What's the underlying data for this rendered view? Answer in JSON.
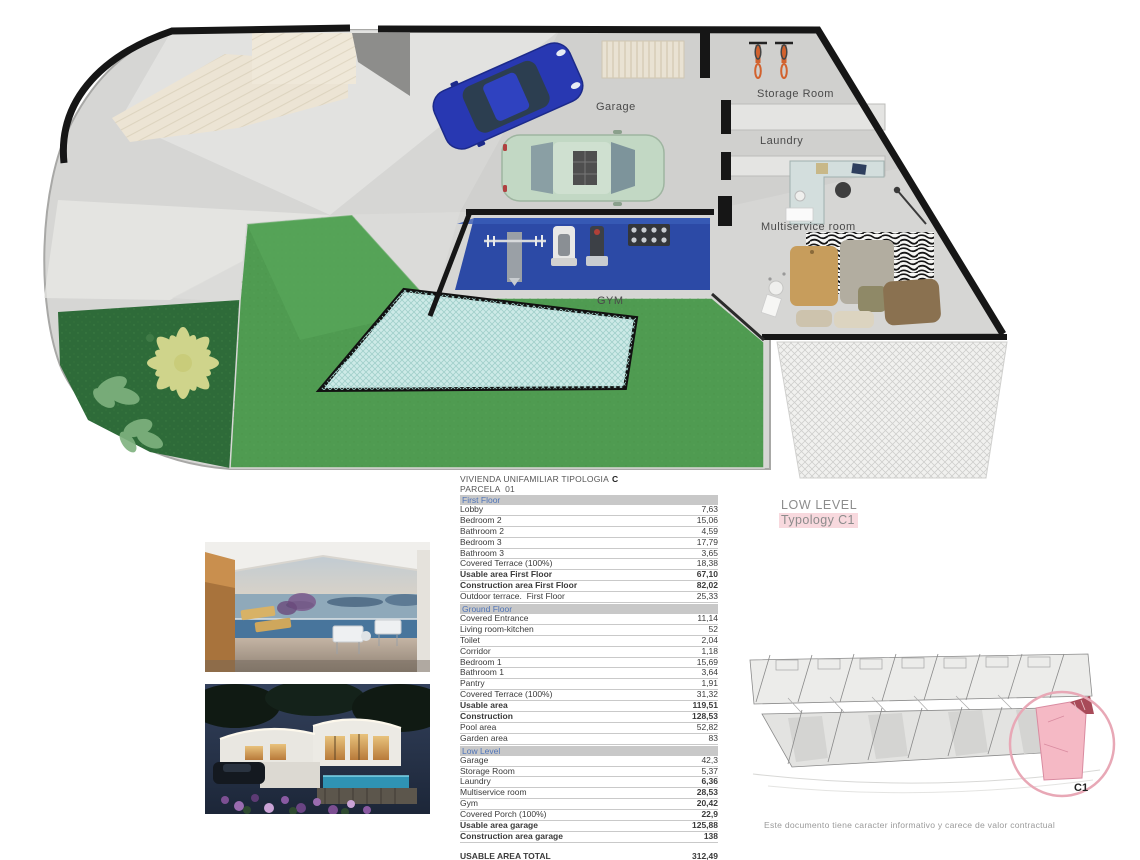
{
  "document": {
    "title_line1": "VIVIENDA UNIFAMILIAR TIPOLOGIA",
    "title_type": "C",
    "title_line2": "PARCELA  01",
    "level_label": "LOW LEVEL",
    "typology_label": "Typology C1",
    "disclaimer": "Este documento tiene caracter informativo y carece de valor contractual",
    "accent_pink": "#f8d9de",
    "section_header_bg": "#c8c8c8",
    "section_header_text": "#4f74b8"
  },
  "floor_plan": {
    "labels": {
      "garage": "Garage",
      "storage": "Storage Room",
      "laundry": "Laundry",
      "multiservice": "Multiservice room",
      "gym": "GYM"
    }
  },
  "area_table": {
    "sections": [
      {
        "name": "First Floor",
        "rows": [
          {
            "label": "Lobby",
            "value": "7,63"
          },
          {
            "label": "Bedroom 2",
            "value": "15,06"
          },
          {
            "label": "Bathroom 2",
            "value": "4,59"
          },
          {
            "label": "Bedroom 3",
            "value": "17,79"
          },
          {
            "label": "Bathroom 3",
            "value": "3,65"
          },
          {
            "label": "Covered Terrace (100%)",
            "value": "18,38"
          },
          {
            "label": "Usable area First Floor",
            "value": "67,10",
            "b": true
          },
          {
            "label": "Construction area First Floor",
            "value": "82,02",
            "b": true
          },
          {
            "label": "Outdoor terrace.  First Floor",
            "value": "25,33"
          }
        ]
      },
      {
        "name": "Ground Floor",
        "rows": [
          {
            "label": "Covered Entrance",
            "value": "11,14"
          },
          {
            "label": "Living room-kitchen",
            "value": "52"
          },
          {
            "label": "Toilet",
            "value": "2,04"
          },
          {
            "label": "Corridor",
            "value": "1,18"
          },
          {
            "label": "Bedroom 1",
            "value": "15,69"
          },
          {
            "label": "Bathroom 1",
            "value": "3,64"
          },
          {
            "label": "Pantry",
            "value": "1,91"
          },
          {
            "label": "Covered Terrace (100%)",
            "value": "31,32"
          },
          {
            "label": "Usable area",
            "value": "119,51",
            "b": true
          },
          {
            "label": "Construction",
            "value": "128,53",
            "b": true
          },
          {
            "label": "Pool area",
            "value": "52,82"
          },
          {
            "label": "Garden area",
            "value": "83"
          }
        ]
      },
      {
        "name": "Low Level",
        "rows": [
          {
            "label": "Garage",
            "value": "42,3"
          },
          {
            "label": "Storage Room",
            "value": "5,37"
          },
          {
            "label": "Laundry",
            "value": "6,36",
            "vb": true
          },
          {
            "label": "Multiservice room",
            "value": "28,53",
            "vb": true
          },
          {
            "label": "Gym",
            "value": "20,42",
            "vb": true
          },
          {
            "label": "Covered Porch (100%)",
            "value": "22,9",
            "vb": true
          },
          {
            "label": "Usable area garage",
            "value": "125,88",
            "b": true
          },
          {
            "label": "Construction area garage",
            "value": "138",
            "b": true
          }
        ]
      }
    ],
    "totals": [
      {
        "label": "USABLE AREA TOTAL",
        "value": "312,49"
      },
      {
        "label": "CONSTRUCTION AREA TOTAL",
        "value": "348,55"
      }
    ]
  },
  "site_plan": {
    "unit_label": "C1"
  }
}
